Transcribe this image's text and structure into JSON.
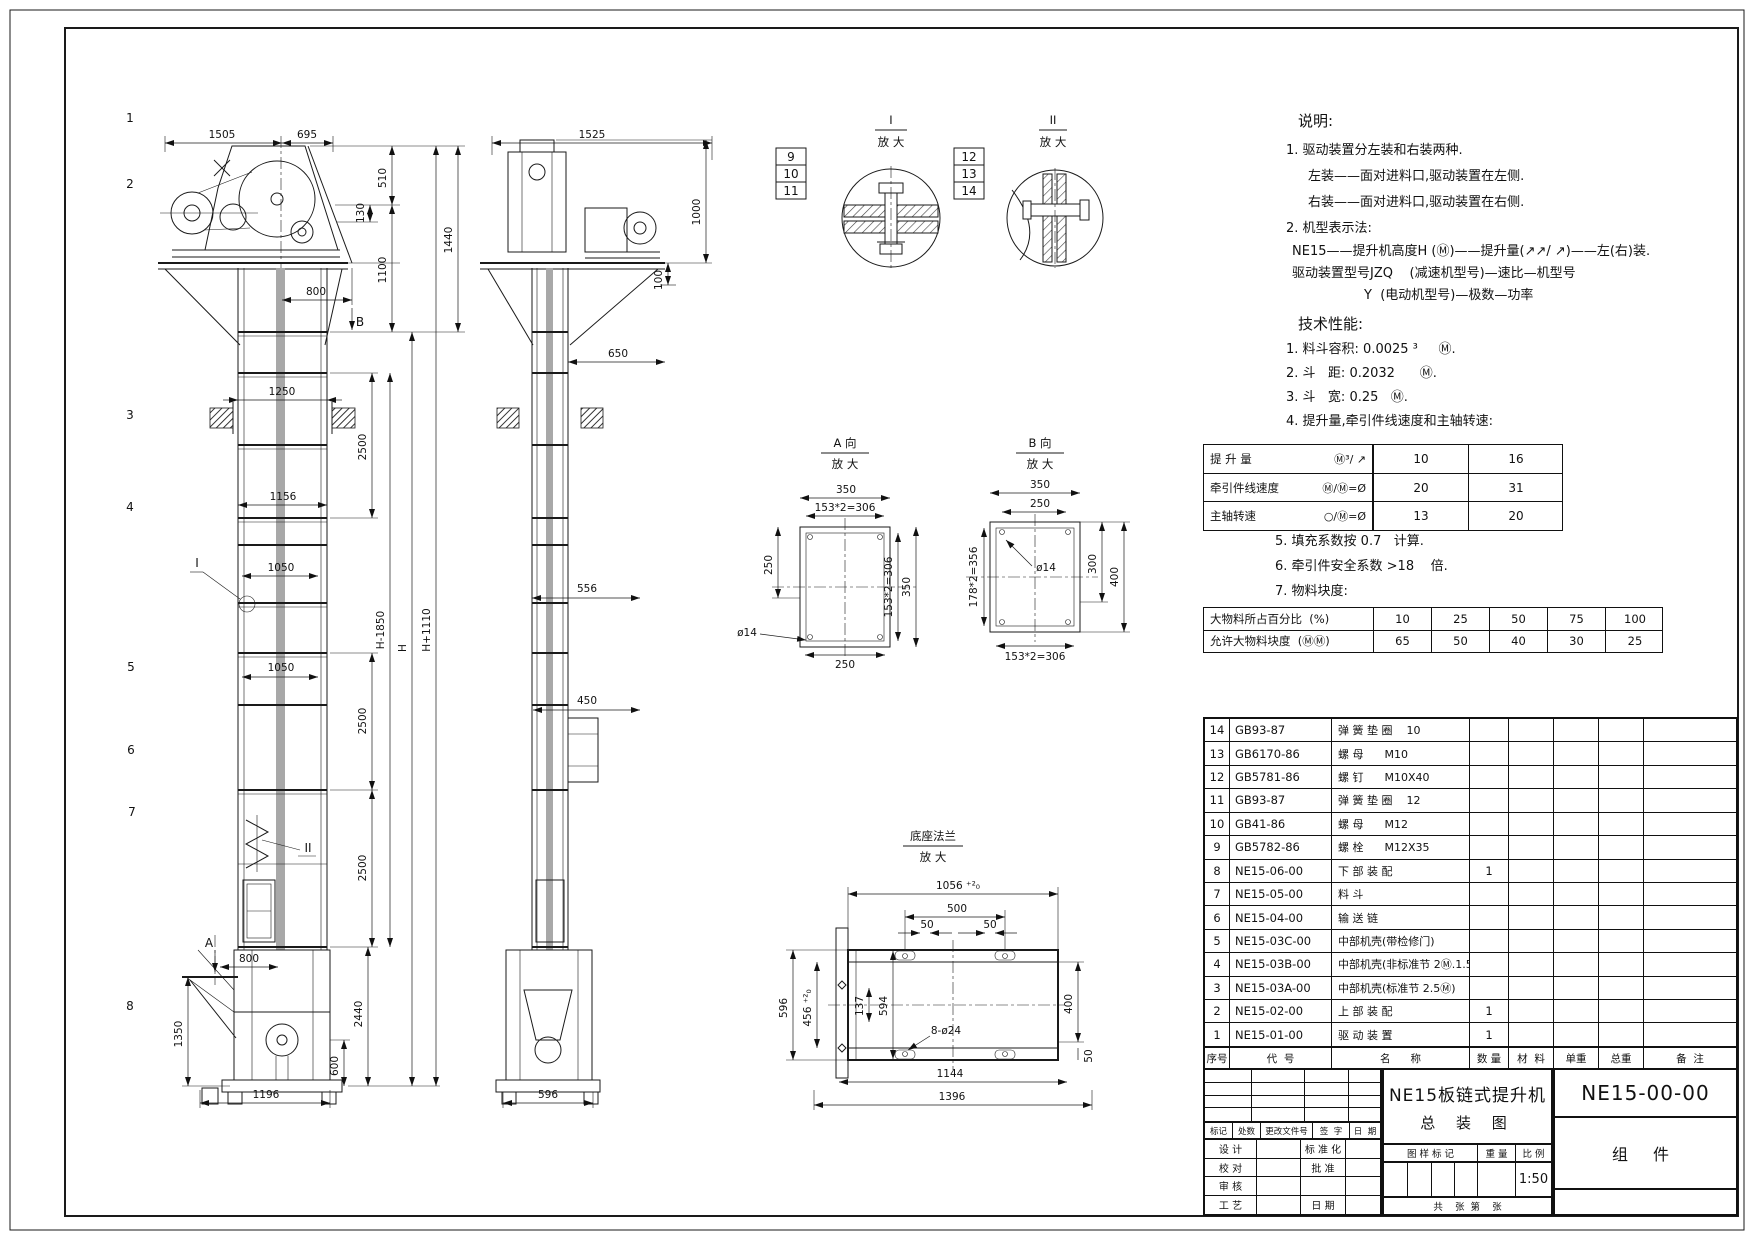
{
  "drawing": {
    "fv": {
      "callouts": [
        "1",
        "2",
        "3",
        "4",
        "5",
        "6",
        "7",
        "8"
      ],
      "d": {
        "w1505": "1505",
        "w695": "695",
        "h510": "510",
        "h130": "130",
        "h1100": "1100",
        "h1440": "1440",
        "w800": "800",
        "secB": "B",
        "w1250": "1250",
        "h2500a": "2500",
        "w1156": "1156",
        "w1050a": "1050",
        "detI": "I",
        "hH1850": "H-1850",
        "hH": "H",
        "hH1110": "H+1110",
        "w1050b": "1050",
        "h2500b": "2500",
        "h2500c": "2500",
        "secA": "A",
        "w800b": "800",
        "h2440": "2440",
        "h1350": "1350",
        "h600": "600",
        "w1196": "1196",
        "detII": "II"
      }
    },
    "sv": {
      "d": {
        "w1525": "1525",
        "h1000": "1000",
        "h100": "100",
        "w650": "650",
        "w556": "556",
        "w450": "450",
        "w596": "596"
      }
    },
    "di": {
      "title": "I",
      "sub": "放 大",
      "c": [
        "9",
        "10",
        "11"
      ]
    },
    "dii": {
      "title": "II",
      "sub": "放 大",
      "c": [
        "12",
        "13",
        "14"
      ]
    },
    "va": {
      "title": "A 向",
      "sub": "放 大",
      "d": {
        "t350": "350",
        "t306": "153*2=306",
        "l250": "250",
        "r306": "153*2=306",
        "r350": "350",
        "b250": "250",
        "phi": "ø14"
      }
    },
    "vb": {
      "title": "B 向",
      "sub": "放 大",
      "d": {
        "t350": "350",
        "t250": "250",
        "l356": "178*2=356",
        "phi": "ø14",
        "r300": "300",
        "r400": "400",
        "b306": "153*2=306"
      }
    },
    "vf": {
      "title": "底座法兰",
      "sub": "放 大",
      "d": {
        "t1056": "1056 ⁺²₀",
        "t500": "500",
        "t50a": "50",
        "t50b": "50",
        "l596": "596",
        "l456": "456 ⁺²₀",
        "i137": "137",
        "i594": "594",
        "holes": "8-ø24",
        "r400": "400",
        "r50": "50",
        "b1144": "1144",
        "b1396": "1396"
      }
    }
  },
  "notes": {
    "title": "说明:",
    "l1": "1. 驱动装置分左装和右装两种.",
    "l2": "左装——面对进料口,驱动装置在左侧.",
    "l3": "右装——面对进料口,驱动装置在右侧.",
    "l4": "2. 机型表示法:",
    "l5": "NE15——提升机高度H (Ⓜ)——提升量(↗↗/ ↗)——左(右)装.",
    "l6": "驱动装置型号JZQ    (减速机型号)—速比—机型号",
    "l7": "Y  (电动机型号)—极数—功率"
  },
  "tech": {
    "title": "技术性能:",
    "l1": "1. 料斗容积: 0.0025 ³     Ⓜ.",
    "l2": "2. 斗   距: 0.2032      Ⓜ.",
    "l3": "3. 斗   宽: 0.25   Ⓜ.",
    "l4": "4. 提升量,牵引件线速度和主轴转速:",
    "l5": "5. 填充系数按 0.7   计算.",
    "l6": "6. 牵引件安全系数 >18    倍.",
    "l7": "7. 物料块度:"
  },
  "perf": {
    "rows": [
      {
        "label": "提 升 量",
        "sym": "Ⓜ³/ ↗",
        "v1": "10",
        "v2": "16"
      },
      {
        "label": "牵引件线速度",
        "sym": "Ⓜ/Ⓜ=Ø",
        "v1": "20",
        "v2": "31"
      },
      {
        "label": "主轴转速",
        "sym": "○/Ⓜ=Ø",
        "v1": "13",
        "v2": "20"
      }
    ]
  },
  "size": {
    "rows": [
      {
        "label": "大物料所占百分比  (%)",
        "v": [
          "10",
          "25",
          "50",
          "75",
          "100"
        ]
      },
      {
        "label": "允许大物料块度  (ⓂⓂ)",
        "v": [
          "65",
          "50",
          "40",
          "30",
          "25"
        ]
      }
    ]
  },
  "bom": {
    "header": {
      "no": "序号",
      "code": "代  号",
      "name": "名      称",
      "qty": "数 量",
      "mat": "材  料",
      "unit": "单重",
      "tot": "总重",
      "rem": "备  注"
    },
    "rows": [
      {
        "no": "14",
        "code": "GB93-87",
        "name": "弹 簧 垫 圈    10",
        "qty": ""
      },
      {
        "no": "13",
        "code": "GB6170-86",
        "name": "螺 母      M10",
        "qty": ""
      },
      {
        "no": "12",
        "code": "GB5781-86",
        "name": "螺 钉      M10X40",
        "qty": ""
      },
      {
        "no": "11",
        "code": "GB93-87",
        "name": "弹 簧 垫 圈    12",
        "qty": ""
      },
      {
        "no": "10",
        "code": "GB41-86",
        "name": "螺 母      M12",
        "qty": ""
      },
      {
        "no": "9",
        "code": "GB5782-86",
        "name": "螺 栓      M12X35",
        "qty": ""
      },
      {
        "no": "8",
        "code": "NE15-06-00",
        "name": "下 部 装 配",
        "qty": "1"
      },
      {
        "no": "7",
        "code": "NE15-05-00",
        "name": "料 斗",
        "qty": ""
      },
      {
        "no": "6",
        "code": "NE15-04-00",
        "name": "输 送 链",
        "qty": ""
      },
      {
        "no": "5",
        "code": "NE15-03C-00",
        "name": "中部机壳(带检修门)",
        "qty": ""
      },
      {
        "no": "4",
        "code": "NE15-03B-00",
        "name": "中部机壳(非标准节 2Ⓜ.1.5Ⓜ)",
        "qty": ""
      },
      {
        "no": "3",
        "code": "NE15-03A-00",
        "name": "中部机壳(标准节 2.5Ⓜ)",
        "qty": ""
      },
      {
        "no": "2",
        "code": "NE15-02-00",
        "name": "上 部 装 配",
        "qty": "1"
      },
      {
        "no": "1",
        "code": "NE15-01-00",
        "name": "驱 动 装 置",
        "qty": "1"
      }
    ]
  },
  "tb": {
    "t1": "NE15板链式提升机",
    "t2": "总 装 图",
    "no": "NE15-00-00",
    "part": "组 件",
    "scale": "1:50",
    "h_mark": "图 样 标 记",
    "h_weight": "重 量",
    "h_scale": "比 例",
    "sheet": "共    张  第    张",
    "r_biaoji": "标记",
    "r_chushu": "处数",
    "r_wenjian": "更改文件号",
    "r_qianzi": "签  字",
    "r_riqi": "日  期",
    "l_sheji": "设 计",
    "l_biaozhunhua": "标 准 化",
    "l_jiaodui": "校 对",
    "l_pizhun": "批 准",
    "l_shenhe": "审 核",
    "l_gongyi": "工 艺",
    "l_riqi": "日 期"
  }
}
